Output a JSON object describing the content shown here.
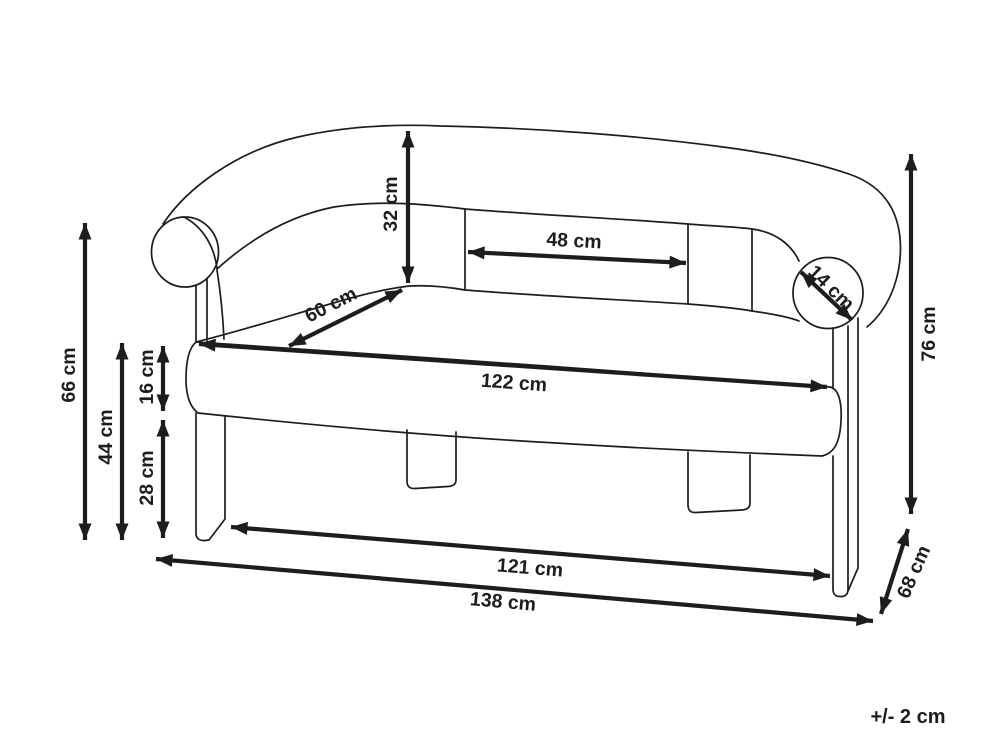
{
  "diagram": {
    "product": "two-seater-sofa-dimension-drawing",
    "unit": "cm",
    "tolerance_note": "+/- 2 cm",
    "colors": {
      "line": "#1d1d1b",
      "background": "#ffffff"
    },
    "dimensions": {
      "back_height_66": "66 cm",
      "seat_top_height_44": "44 cm",
      "seat_thickness_16": "16 cm",
      "under_seat_height_28": "28 cm",
      "backrest_height_32": "32 cm",
      "back_panel_width_48": "48 cm",
      "seat_depth_60": "60 cm",
      "seat_width_122": "122 cm",
      "leg_span_width_121": "121 cm",
      "overall_width_138": "138 cm",
      "armrest_diameter_14": "14 cm",
      "overall_height_76": "76 cm",
      "overall_depth_68": "68 cm"
    }
  }
}
